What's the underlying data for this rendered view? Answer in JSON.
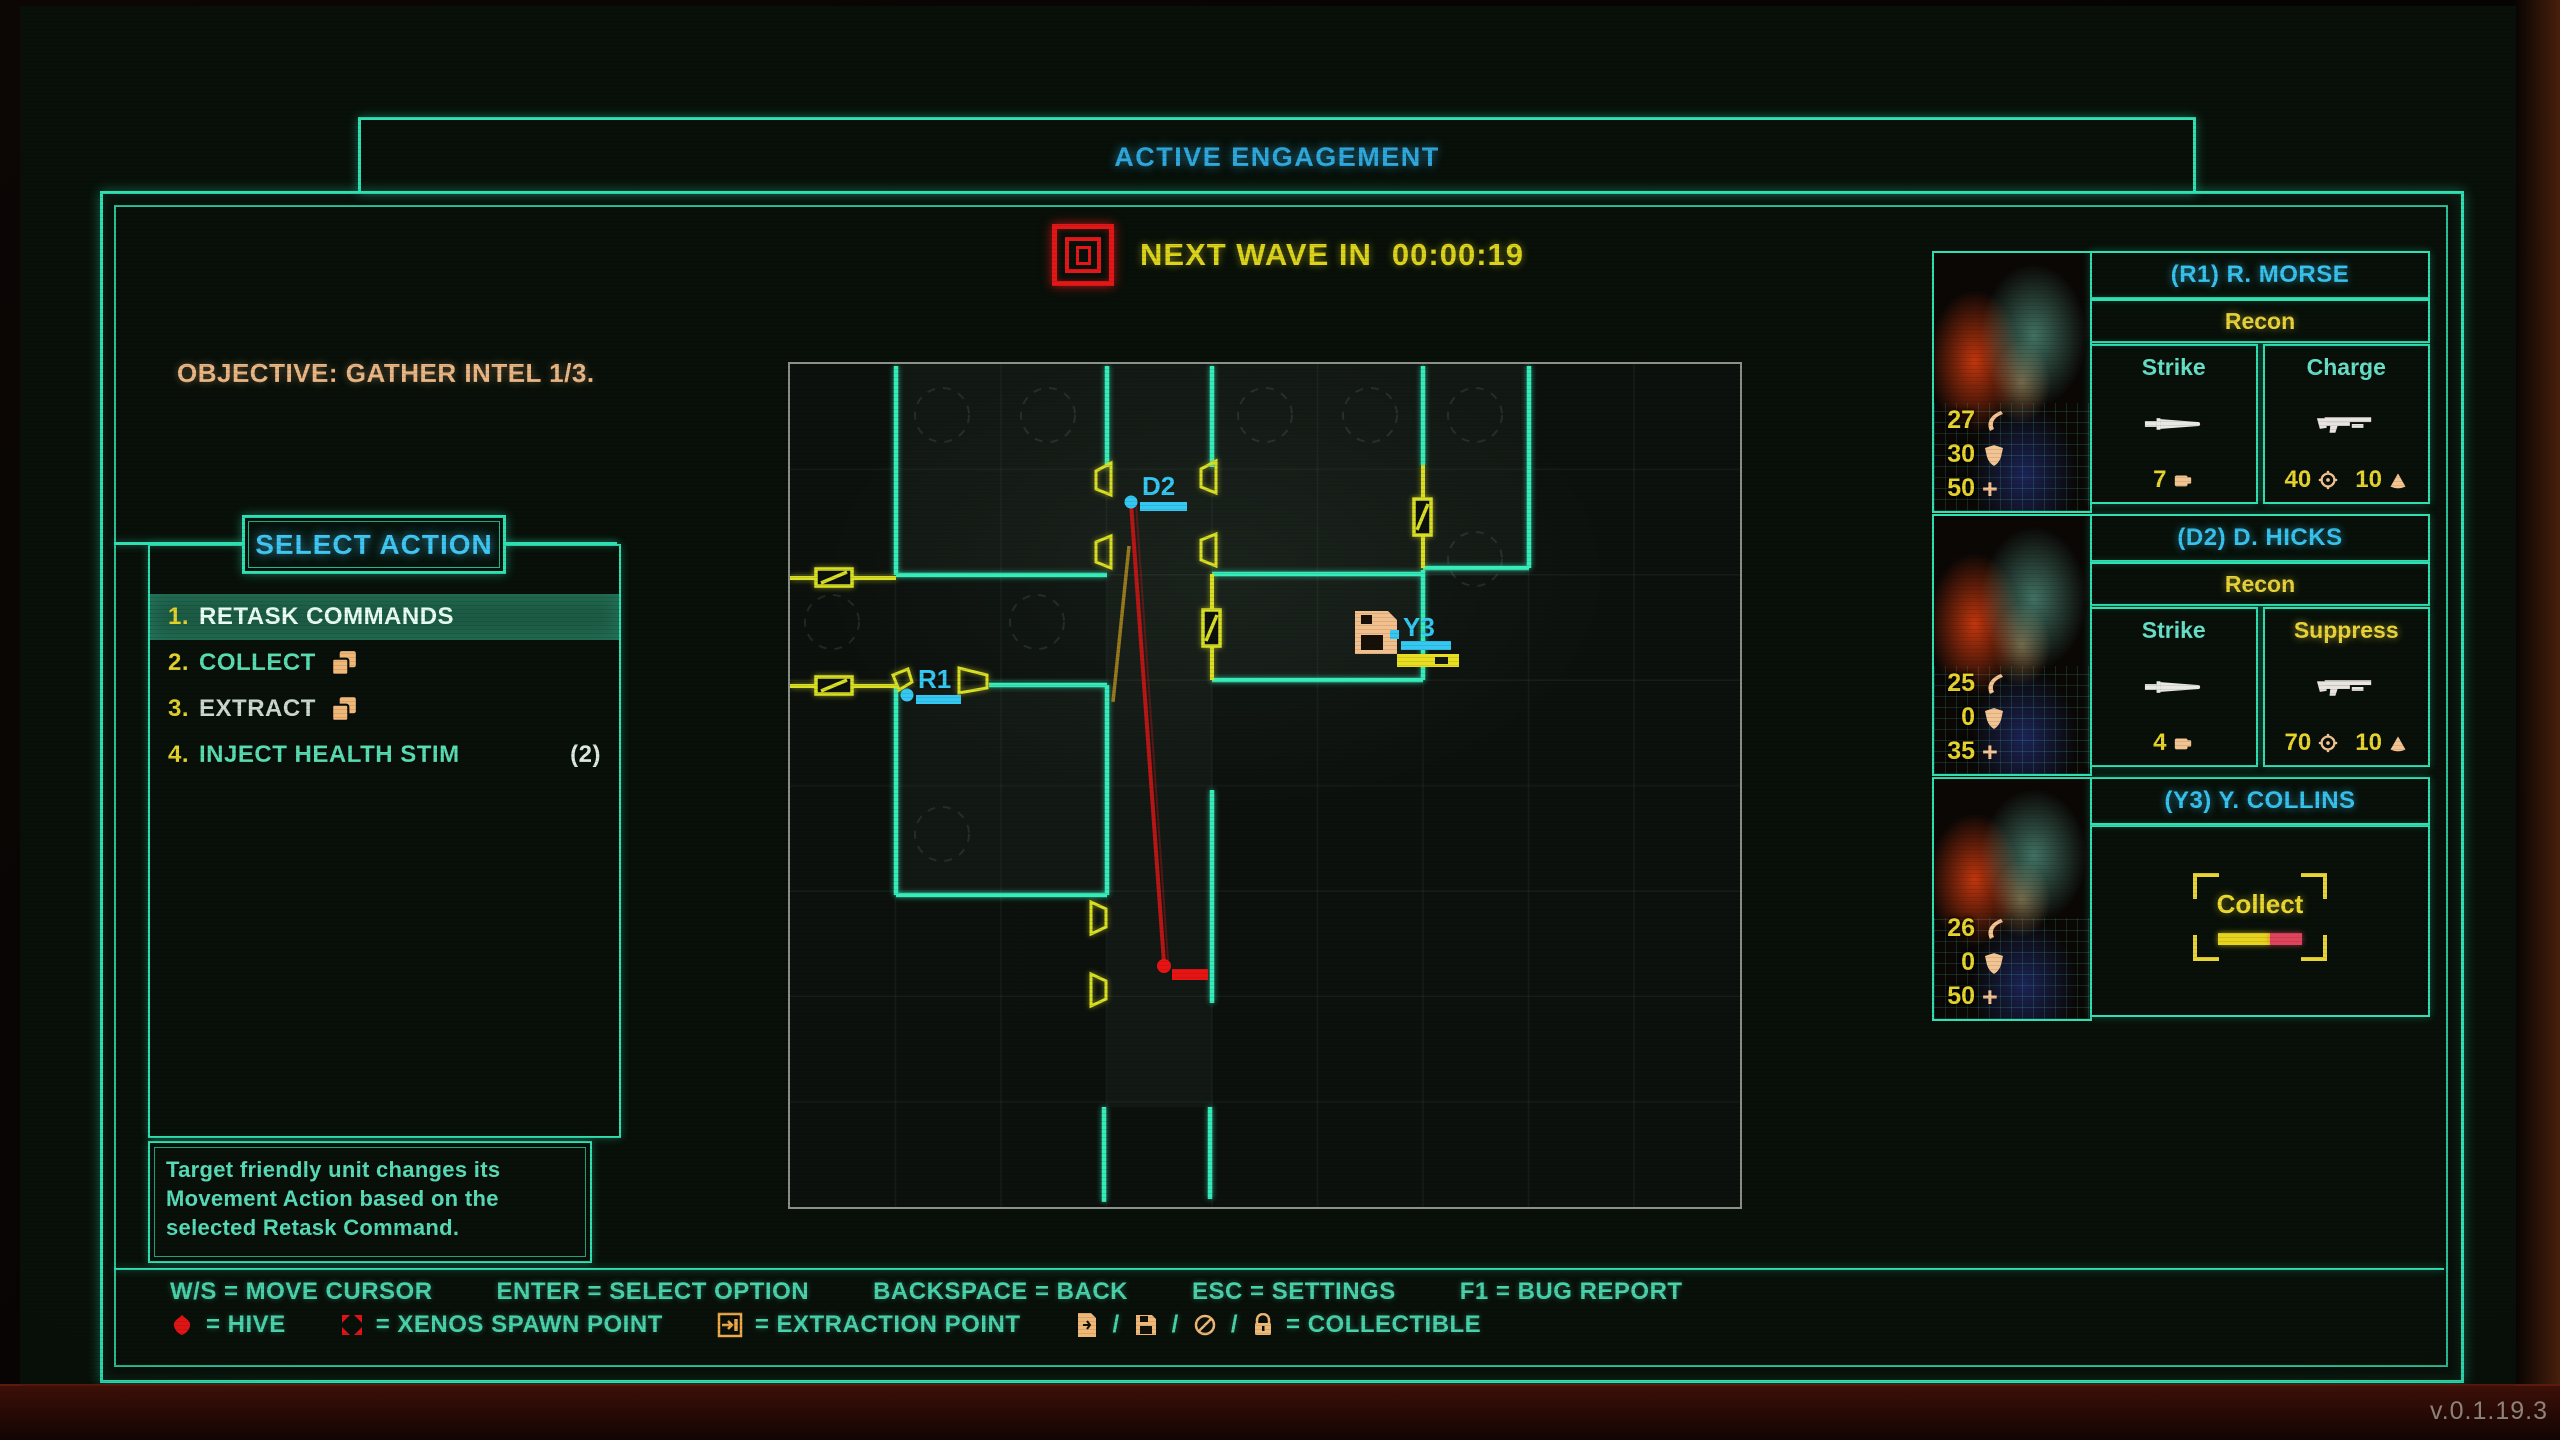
{
  "header": {
    "title": "ACTIVE ENGAGEMENT"
  },
  "wave": {
    "label": "NEXT WAVE IN",
    "time": "00:00:19",
    "icon": "wave-alert-icon",
    "accent_color": "#e31717",
    "text_color": "#dcd41c"
  },
  "objective": {
    "text": "OBJECTIVE: GATHER INTEL 1/3."
  },
  "menu": {
    "header": "SELECT ACTION",
    "items": [
      {
        "number": "1.",
        "label": "RETASK COMMANDS",
        "selected": true
      },
      {
        "number": "2.",
        "label": "COLLECT",
        "icon": "collectible-squares-icon"
      },
      {
        "number": "3.",
        "label": "EXTRACT",
        "icon": "collectible-squares-icon"
      },
      {
        "number": "4.",
        "label": "INJECT HEALTH STIM",
        "count": "(2)"
      }
    ],
    "description": "Target friendly unit changes its Movement Action based on the selected Retask Command."
  },
  "map": {
    "units": [
      {
        "label": "R1",
        "color": "#35c8f2"
      },
      {
        "label": "D2",
        "color": "#35c8f2"
      },
      {
        "label": "Y3",
        "color": "#35c8f2",
        "marker": "floppy-collectible-icon"
      }
    ],
    "wall_color": "#35ecba",
    "door_color": "#d8df25",
    "threat_color": "#e31717"
  },
  "squad": [
    {
      "tag": "(R1) R. MORSE",
      "class": "Recon",
      "stats": {
        "kills": "27",
        "armor": "30",
        "health": "50"
      },
      "actions": [
        {
          "label": "Strike",
          "weapon_icon": "knife-icon",
          "cost": [
            {
              "value": "7",
              "icon": "melee-icon"
            }
          ]
        },
        {
          "label": "Charge",
          "weapon_icon": "shotgun-icon",
          "cost": [
            {
              "value": "40",
              "icon": "accuracy-icon"
            },
            {
              "value": "10",
              "icon": "ammo-icon"
            }
          ]
        }
      ]
    },
    {
      "tag": "(D2) D. HICKS",
      "class": "Recon",
      "stats": {
        "kills": "25",
        "armor": "0",
        "health": "35"
      },
      "actions": [
        {
          "label": "Strike",
          "weapon_icon": "knife-icon",
          "cost": [
            {
              "value": "4",
              "icon": "melee-icon"
            }
          ]
        },
        {
          "label": "Suppress",
          "highlighted": true,
          "weapon_icon": "shotgun-icon",
          "cost": [
            {
              "value": "70",
              "icon": "accuracy-icon"
            },
            {
              "value": "10",
              "icon": "ammo-icon"
            }
          ]
        }
      ]
    },
    {
      "tag": "(Y3) Y. COLLINS",
      "stats": {
        "kills": "26",
        "armor": "0",
        "health": "50"
      },
      "collect_label": "Collect",
      "collect_progress": 0.62
    }
  ],
  "hints": [
    "W/S = MOVE CURSOR",
    "ENTER = SELECT OPTION",
    "BACKSPACE = BACK",
    "ESC = SETTINGS",
    "F1 = BUG REPORT"
  ],
  "legend": [
    {
      "icon": "hive-icon",
      "text": "= HIVE"
    },
    {
      "icon": "xenos-spawn-icon",
      "text": "= XENOS SPAWN POINT"
    },
    {
      "icon": "extraction-icon",
      "text": "= EXTRACTION POINT"
    },
    {
      "icons": [
        "document-icon",
        "floppy-icon",
        "disc-icon",
        "lock-icon"
      ],
      "separator": "/",
      "text": "= COLLECTIBLE"
    }
  ],
  "icons": {
    "health_glyph": "+"
  },
  "version": "v.0.1.19.3"
}
